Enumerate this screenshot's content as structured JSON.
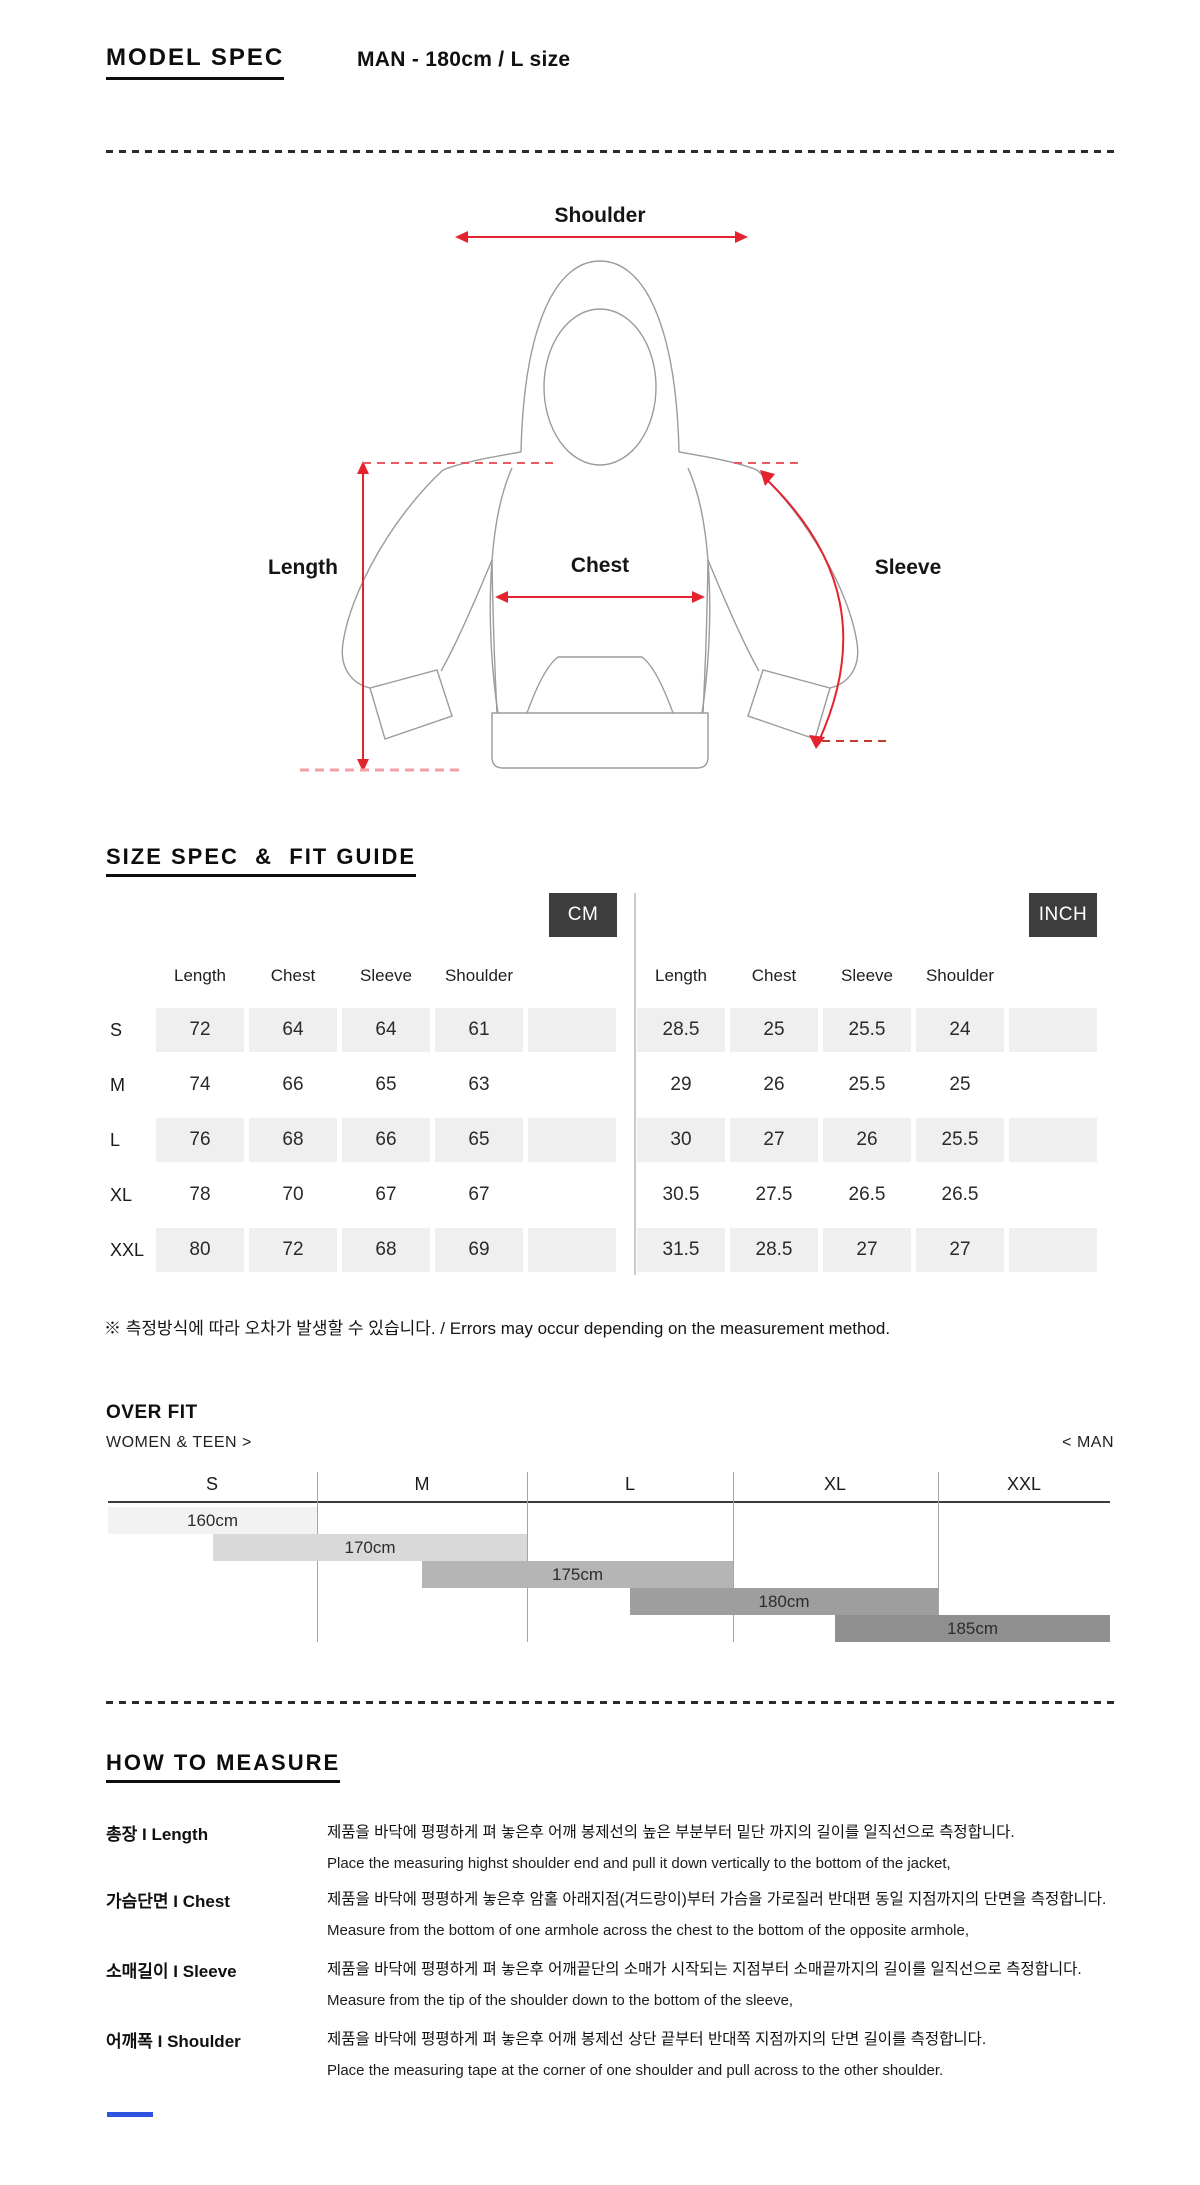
{
  "header": {
    "title": "MODEL SPEC",
    "subtitle": "MAN - 180cm / L size"
  },
  "diagram": {
    "labels": {
      "shoulder": "Shoulder",
      "length": "Length",
      "chest": "Chest",
      "sleeve": "Sleeve"
    },
    "accent_color": "#e5232e",
    "dash_color": "#ea5a62",
    "outline_color": "#9b9b9b"
  },
  "size_section": {
    "heading": "SIZE SPEC  &  FIT GUIDE",
    "badge_bg": "#3d3d3d",
    "unit_badges": {
      "cm": "CM",
      "inch": "INCH"
    },
    "columns": [
      "Length",
      "Chest",
      "Sleeve",
      "Shoulder"
    ],
    "rows": [
      {
        "size": "S",
        "cm": [
          "72",
          "64",
          "64",
          "61"
        ],
        "inch": [
          "28.5",
          "25",
          "25.5",
          "24"
        ]
      },
      {
        "size": "M",
        "cm": [
          "74",
          "66",
          "65",
          "63"
        ],
        "inch": [
          "29",
          "26",
          "25.5",
          "25"
        ]
      },
      {
        "size": "L",
        "cm": [
          "76",
          "68",
          "66",
          "65"
        ],
        "inch": [
          "30",
          "27",
          "26",
          "25.5"
        ]
      },
      {
        "size": "XL",
        "cm": [
          "78",
          "70",
          "67",
          "67"
        ],
        "inch": [
          "30.5",
          "27.5",
          "26.5",
          "26.5"
        ]
      },
      {
        "size": "XXL",
        "cm": [
          "80",
          "72",
          "68",
          "69"
        ],
        "inch": [
          "31.5",
          "28.5",
          "27",
          "27"
        ]
      }
    ],
    "shaded_row_bg": "#efefef",
    "note": "※ 측정방식에 따라 오차가 발생할 수 있습니다. / Errors may occur depending on the measurement method."
  },
  "fit_guide": {
    "title": "OVER FIT",
    "left_label": "WOMEN & TEEN >",
    "right_label": "< MAN",
    "sizes": [
      "S",
      "M",
      "L",
      "XL",
      "XXL"
    ],
    "bars": [
      {
        "label": "160cm",
        "color": "#f2f2f2",
        "span_sizes": [
          "S"
        ]
      },
      {
        "label": "170cm",
        "color": "#d9d9d9",
        "span_sizes": [
          "S",
          "M"
        ]
      },
      {
        "label": "175cm",
        "color": "#b5b5b5",
        "span_sizes": [
          "M",
          "L"
        ]
      },
      {
        "label": "180cm",
        "color": "#9e9e9e",
        "span_sizes": [
          "L",
          "XL"
        ]
      },
      {
        "label": "185cm",
        "color": "#8f8f8f",
        "span_sizes": [
          "XL",
          "XXL"
        ]
      }
    ]
  },
  "measure_section": {
    "heading": "HOW TO MEASURE",
    "rows": [
      {
        "label": "총장 I Length",
        "kr": "제품을 바닥에 평평하게 펴 놓은후 어깨 봉제선의 높은 부분부터 밑단 까지의 길이를 일직선으로 측정합니다.",
        "en": "Place the measuring highst shoulder end and pull it down vertically to the bottom of the jacket,"
      },
      {
        "label": "가슴단면 I Chest",
        "kr": "제품을 바닥에 평평하게 놓은후 암홀 아래지점(겨드랑이)부터 가슴을 가로질러 반대편 동일 지점까지의 단면을 측정합니다.",
        "en": "Measure from the bottom of one armhole across the chest to the bottom of the opposite armhole,"
      },
      {
        "label": "소매길이 I Sleeve",
        "kr": "제품을 바닥에 평평하게 펴 놓은후 어깨끝단의 소매가 시작되는 지점부터 소매끝까지의 길이를 일직선으로 측정합니다.",
        "en": "Measure from the tip of the shoulder down to the bottom of the sleeve,"
      },
      {
        "label": "어깨폭 I Shoulder",
        "kr": "제품을 바닥에 평평하게 펴 놓은후 어깨 봉제선 상단 끝부터 반대쪽 지점까지의 단면 길이를 측정합니다.",
        "en": "Place the measuring tape at the corner of one shoulder and pull across to the other shoulder."
      }
    ]
  }
}
